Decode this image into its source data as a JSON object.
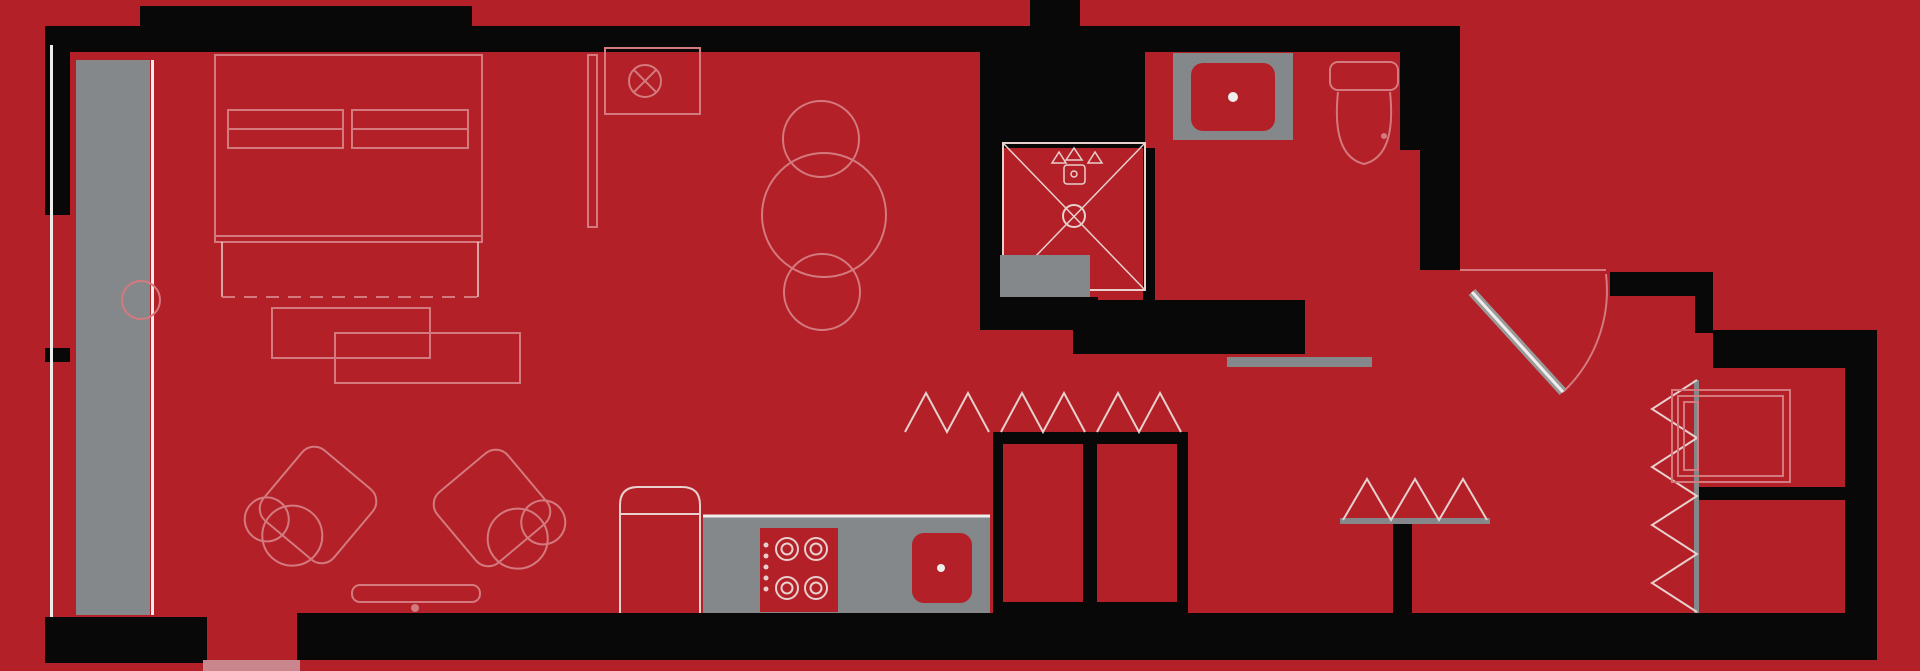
{
  "meta": {
    "title": "Studio apartment floor plan rendered in red and black",
    "type": "architectural-floor-plan",
    "visible_text": "none"
  },
  "colors": {
    "background": "#b32028",
    "wall": "#080808",
    "gray": "#85888b",
    "outline": "#d4797e",
    "bright": "#e7d0cd",
    "white": "#efeeec",
    "threshold": "#c9868d"
  },
  "fixtures": [
    "bed",
    "pillow",
    "bench",
    "side-table",
    "stool",
    "wardrobe-partition",
    "ceiling-fixture",
    "dining-table",
    "dining-chair",
    "armchair",
    "tv-console",
    "refrigerator",
    "kitchen-counter",
    "cooktop",
    "burner",
    "kitchen-sink",
    "bifold-closet-doors",
    "corridor-closets",
    "shower",
    "shower-head",
    "shower-drain",
    "shower-curb",
    "vanity-sink",
    "toilet",
    "bathroom-sliding-door",
    "entry-door",
    "door-swing-arc",
    "accordion-door",
    "washer",
    "small-closet",
    "balcony-threshold",
    "window-wall"
  ]
}
